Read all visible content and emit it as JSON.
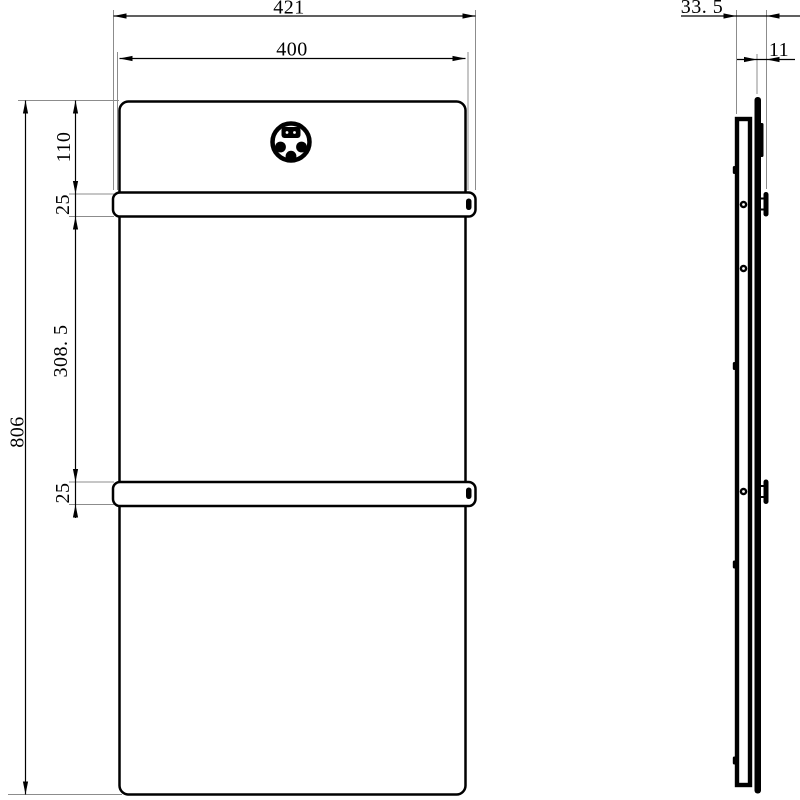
{
  "views": {
    "front": {
      "dims": {
        "outer_width": "421",
        "inner_width": "400",
        "top_offset": "110",
        "rail_top_height": "25",
        "rail_spacing": "308. 5",
        "rail_bottom_height": "25",
        "overall_height": "806"
      }
    },
    "side": {
      "dims": {
        "overall_depth": "33. 5",
        "panel_thickness": "11"
      }
    }
  },
  "icons": {
    "logo": "control-dial-icon"
  },
  "colors": {
    "line": "#000000",
    "extension_line": "#8c8c8c",
    "background": "#ffffff"
  }
}
